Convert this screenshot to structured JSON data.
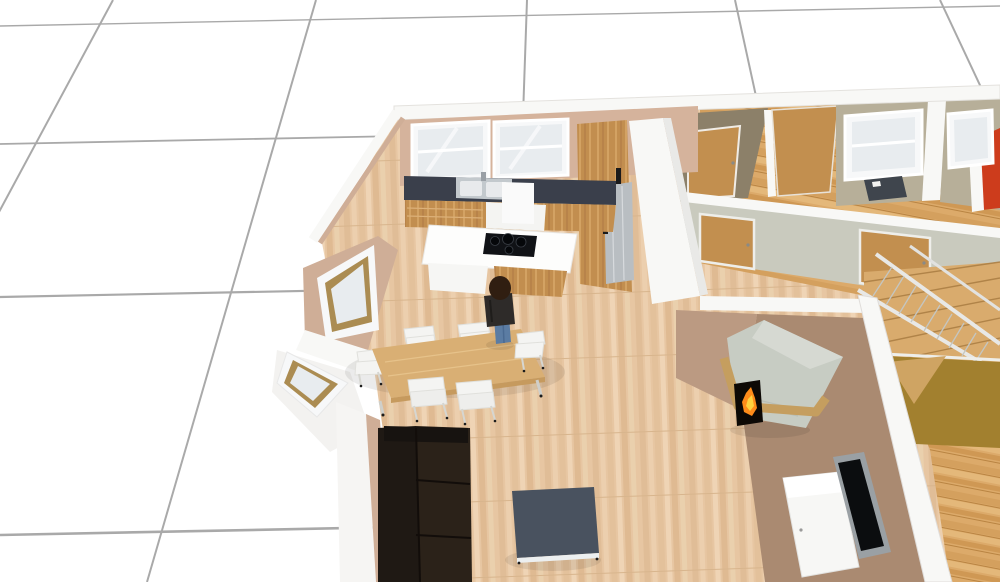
{
  "app": {
    "view_label": "3D floor plan perspective view",
    "canvas": {
      "width": 1000,
      "height": 582
    }
  },
  "colors": {
    "grid_line": "#9b9b9b",
    "wall_white": "#f8f8f6",
    "wall_white_shade": "#e9e9e7",
    "wall_tan": "#d5b39c",
    "wall_tan_light": "#cfae97",
    "wall_brown_light": "#bb9a82",
    "wall_brown": "#aa8a71",
    "wall_gray": "#c9cabe",
    "wall_beige": "#b7af99",
    "wall_olive": "#8c8069",
    "wall_red": "#cd3c1c",
    "wall_mustard": "#a2802f",
    "counter_dark": "#3a3f4b",
    "steel": "#b9bec2",
    "sink_steel": "#c3c9cd",
    "sink_bowl": "#e8eaec",
    "dishwasher_white": "#f4f4f2",
    "island_white": "#fdfdfc",
    "cooktop_black": "#101216",
    "burner": "#05070a",
    "door_wood": "#c28f4f",
    "door_frame": "#f0ece6",
    "window_frame": "#f7f8f9",
    "window_reveal_wood": "#ab8c52",
    "glass": "#e8ecef",
    "table_wood": "#d9af74",
    "table_edge": "#c69a5e",
    "chair_white": "#f4f4f2",
    "sofa_back": "#1f1914",
    "sofa_seat": "#2b2219",
    "sofa_arm": "#171310",
    "coffee_top": "#49525f",
    "coffee_frame": "#eceff0",
    "tv_frame": "#9aa0a4",
    "tv_screen": "#0b0d0f",
    "sideboard_white": "#f7f7f5",
    "sideboard_top": "#ffffff",
    "fireplace_body": "#c7ccc3",
    "fireplace_top": "#d6d9d2",
    "mantel_wood": "#c59e5f",
    "fire_black": "#0d0905",
    "fire_orange": "#ff8c1a",
    "fire_yellow": "#ffd23e",
    "person_hair": "#301e11",
    "person_jacket": "#2e2b29",
    "person_jeans": "#5b7ca3",
    "stair_wood": "#d9ab6d",
    "stair_rail": "#e8e8e6",
    "stair_foot_wood": "#cfa463",
    "desk_dark": "#3f454d",
    "handle_dark": "#1a1a1a"
  },
  "scene": {
    "rooms": [
      "kitchen",
      "dining area",
      "living room",
      "hallway",
      "staircase",
      "bedrooms"
    ],
    "objects": [
      "perspective floor grid",
      "kitchen window x2",
      "kitchen sink with faucet",
      "dark countertop",
      "base cabinets with dishwasher",
      "tall cabinets with refrigerator",
      "kitchen island with induction cooktop",
      "bay window x2",
      "dining table",
      "dining chair x6",
      "standing person",
      "sofa",
      "coffee table",
      "corner fireplace with fire",
      "media sideboard",
      "flat screen tv",
      "hallway wall with doors",
      "bedroom doors",
      "bedroom window x2",
      "red accent wall",
      "desk with chair",
      "staircase with railing",
      "mustard stairwell wall"
    ]
  }
}
